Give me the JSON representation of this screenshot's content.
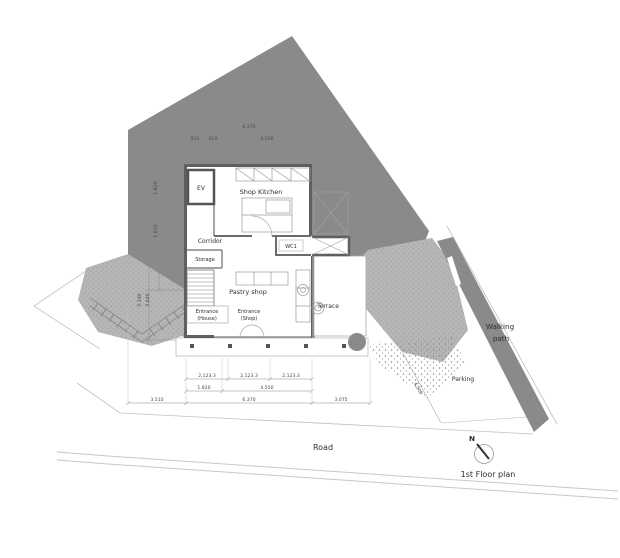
{
  "drawing": {
    "title": "1st Floor plan",
    "north_label": "N",
    "rooms": {
      "ev": "EV",
      "shop_kitchen": "Shop Kitchen",
      "corridor": "Corridor",
      "storage": "Storage",
      "wc1": "WC1",
      "pastry_shop": "Pastry shop",
      "entrance_house_line1": "Entrance",
      "entrance_house_line2": "(House)",
      "entrance_shop_line1": "Entrance",
      "entrance_shop_line2": "(Shop)",
      "terrace": "Terrace"
    },
    "site": {
      "walking_path_line1": "Walking",
      "walking_path_line2": "path",
      "parking": "Parking",
      "road": "Road"
    },
    "dimensions": {
      "top": {
        "total": "6.370",
        "seg1": "910",
        "seg2": "910",
        "seg3": "4.550"
      },
      "left": {
        "seg1": "1.820",
        "seg2": "1.820",
        "bottom1": "5.190",
        "bottom2": "3.640"
      },
      "bottom_row1": [
        "2,123.3",
        "2,123.3",
        "2,123.3"
      ],
      "bottom_row2": [
        "1.820",
        "4.550"
      ],
      "bottom_row3": [
        "3.510",
        "6.370",
        "3.075"
      ],
      "parking_width": "4.500"
    },
    "colors": {
      "site_fill": "#8a8a8a",
      "texture_fill": "#b6b6b6",
      "wall": "#5f5f5f",
      "dim_text": "#4a4a4a"
    }
  }
}
